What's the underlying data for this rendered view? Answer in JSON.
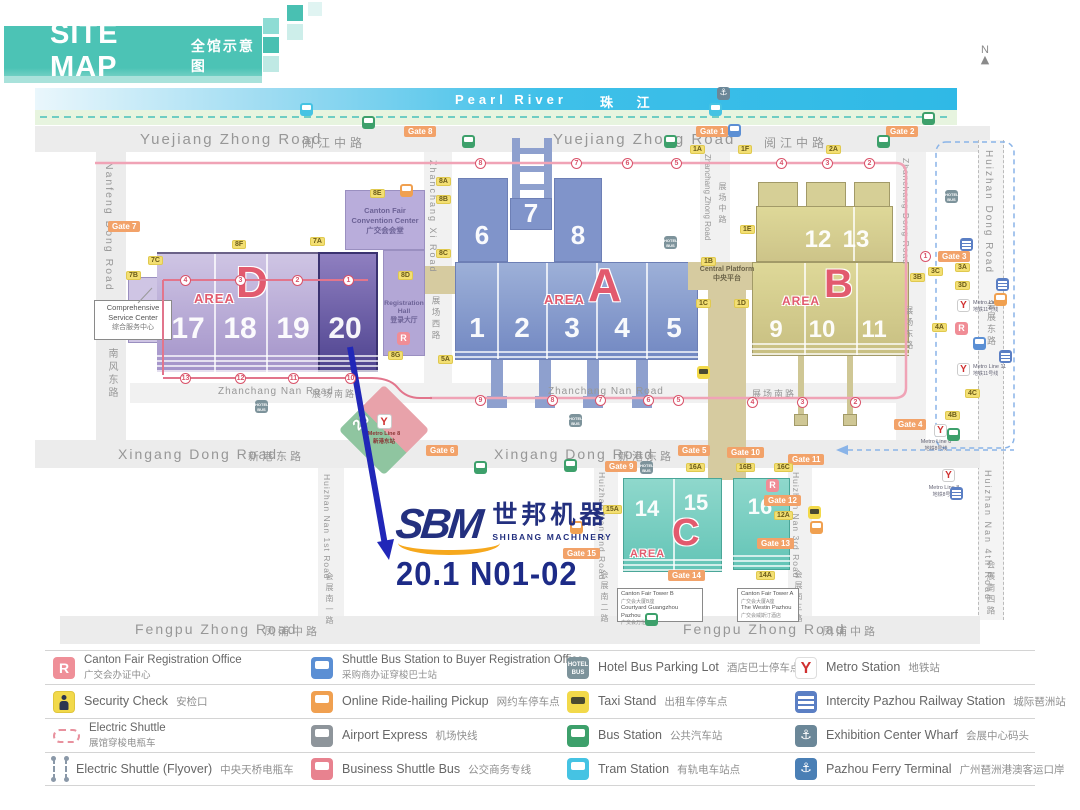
{
  "colors": {
    "accent_teal": "#4cc3b5",
    "booth_navy": "#1d2b87",
    "arrow_blue": "#2127b8",
    "area_letter": "#e25a6e",
    "river_blue": "#2fb9e6"
  },
  "header": {
    "title": "SITE MAP",
    "subtitle": "全馆示意图"
  },
  "compass": {
    "label": "N"
  },
  "river": {
    "en": "Pearl River",
    "zh": "珠 江"
  },
  "roads": {
    "yuejiang_en": "Yuejiang Zhong Road",
    "yuejiang_zh": "阅江中路",
    "nanfeng_en": "Nanfeng Dong Road",
    "nanfeng_zh": "南风东路",
    "huizhan_dong_en": "Huizhan Dong Road",
    "huizhan_dong_zh": "会展东路",
    "zhanchang_xi_en": "Zhanchang Xi Road",
    "zhanchang_xi_zh": "展场西路",
    "zhanchang_zhong_en": "Zhanchang Zhong Road",
    "zhanchang_zhong_zh": "展场中路",
    "zhanchang_dong_en": "Zhanchang Dong Road",
    "zhanchang_dong_zh": "展场东路",
    "zhanchang_nan_en": "Zhanchang Nan Road",
    "zhanchang_nan_zh": "展场南路",
    "xingang_en": "Xingang Dong Road",
    "xingang_zh": "新港东路",
    "fengpu_en": "Fengpu Zhong Road",
    "fengpu_zh": "凤浦中路",
    "hz1_en": "Huizhan Nan 1st Road",
    "hz1_zh": "会展南一路",
    "hz2_en": "Huizhan Nan 2nd Road",
    "hz2_zh": "会展南二路",
    "hz3_en": "Huizhan Nan 3rd Road",
    "hz3_zh": "会展南三路",
    "hz4_en": "Huizhan Nan 4th Road",
    "hz4_zh": "会展南四路"
  },
  "areas": {
    "a": {
      "word": "AREA",
      "letter": "A",
      "halls_top": [
        "6",
        "7",
        "8"
      ],
      "halls_bottom": [
        "1",
        "2",
        "3",
        "4",
        "5"
      ]
    },
    "b": {
      "word": "AREA",
      "letter": "B",
      "halls_top": [
        "12",
        "13"
      ],
      "halls_bottom": [
        "9",
        "10",
        "11"
      ]
    },
    "c": {
      "word": "AREA",
      "letter": "C",
      "halls": [
        "14",
        "15",
        "16"
      ]
    },
    "d": {
      "word": "AREA",
      "letter": "D",
      "halls": [
        "17",
        "18",
        "19",
        "20"
      ]
    }
  },
  "buildings": {
    "convention": {
      "en1": "Canton Fair",
      "en2": "Convention Center",
      "zh": "广交会会堂"
    },
    "registration": {
      "en": "Registration Hall",
      "zh": "登录大厅"
    },
    "service": {
      "en1": "Comprehensive",
      "en2": "Service Center",
      "zh": "综合服务中心"
    },
    "platform": {
      "en": "Central Platform",
      "zh": "中央平台"
    },
    "hotel_b": {
      "l1": "Canton Fair Tower B",
      "l2": "广交会大厦B座",
      "l3": "Courtyard Guangzhou Pazhou",
      "l4": "广交会万怡酒店"
    },
    "hotel_a": {
      "l1": "Canton Fair Tower A",
      "l2": "广交会大厦A座",
      "l3": "The Westin Pazhou",
      "l4": "广交会威斯汀酒店"
    }
  },
  "booth": {
    "logo": "SBM",
    "company_zh": "世邦机器",
    "company_en": "SHIBANG MACHINERY",
    "code": "20.1 N01-02"
  },
  "metro": {
    "diamond_num": "20",
    "diamond_line": "Metro Line 8",
    "diamond_station": "新港东站",
    "line11": "Metro Line 11",
    "line11_zh": "地铁11号线",
    "line8": "Metro Line 8",
    "line8_zh": "地铁8号线"
  },
  "map": {
    "gates": [
      {
        "label": "Gate 7",
        "x": 108,
        "y": 221
      },
      {
        "label": "Gate 8",
        "x": 404,
        "y": 126
      },
      {
        "label": "Gate 1",
        "x": 696,
        "y": 126
      },
      {
        "label": "Gate 2",
        "x": 886,
        "y": 126
      },
      {
        "label": "Gate 3",
        "x": 938,
        "y": 251
      },
      {
        "label": "Gate 4",
        "x": 894,
        "y": 419
      },
      {
        "label": "Gate 5",
        "x": 678,
        "y": 445
      },
      {
        "label": "Gate 6",
        "x": 426,
        "y": 445
      },
      {
        "label": "Gate 9",
        "x": 605,
        "y": 461
      },
      {
        "label": "Gate 10",
        "x": 727,
        "y": 447
      },
      {
        "label": "Gate 11",
        "x": 788,
        "y": 454
      },
      {
        "label": "Gate 12",
        "x": 764,
        "y": 495
      },
      {
        "label": "Gate 13",
        "x": 757,
        "y": 538
      },
      {
        "label": "Gate 14",
        "x": 668,
        "y": 570
      },
      {
        "label": "Gate 15",
        "x": 563,
        "y": 548
      }
    ],
    "chips": [
      {
        "label": "7B",
        "x": 126,
        "y": 271
      },
      {
        "label": "7C",
        "x": 148,
        "y": 256
      },
      {
        "label": "8F",
        "x": 232,
        "y": 240
      },
      {
        "label": "7A",
        "x": 310,
        "y": 237
      },
      {
        "label": "8E",
        "x": 370,
        "y": 189
      },
      {
        "label": "8A",
        "x": 436,
        "y": 177
      },
      {
        "label": "8B",
        "x": 436,
        "y": 195
      },
      {
        "label": "8C",
        "x": 436,
        "y": 249
      },
      {
        "label": "8D",
        "x": 398,
        "y": 271
      },
      {
        "label": "8G",
        "x": 388,
        "y": 351
      },
      {
        "label": "5A",
        "x": 438,
        "y": 355
      },
      {
        "label": "1A",
        "x": 690,
        "y": 145
      },
      {
        "label": "1F",
        "x": 738,
        "y": 145
      },
      {
        "label": "2A",
        "x": 826,
        "y": 145
      },
      {
        "label": "1E",
        "x": 740,
        "y": 225
      },
      {
        "label": "1B",
        "x": 701,
        "y": 257
      },
      {
        "label": "1C",
        "x": 696,
        "y": 299
      },
      {
        "label": "1D",
        "x": 734,
        "y": 299
      },
      {
        "label": "3C",
        "x": 928,
        "y": 267
      },
      {
        "label": "3B",
        "x": 910,
        "y": 273
      },
      {
        "label": "3A",
        "x": 955,
        "y": 263
      },
      {
        "label": "3D",
        "x": 955,
        "y": 281
      },
      {
        "label": "4A",
        "x": 932,
        "y": 323
      },
      {
        "label": "4C",
        "x": 965,
        "y": 389
      },
      {
        "label": "4B",
        "x": 945,
        "y": 411
      },
      {
        "label": "16A",
        "x": 686,
        "y": 463
      },
      {
        "label": "16B",
        "x": 736,
        "y": 463
      },
      {
        "label": "16C",
        "x": 774,
        "y": 463
      },
      {
        "label": "12A",
        "x": 774,
        "y": 511
      },
      {
        "label": "14A",
        "x": 756,
        "y": 571
      },
      {
        "label": "15A",
        "x": 603,
        "y": 505
      }
    ],
    "stops": [
      {
        "n": "4",
        "x": 180,
        "y": 275
      },
      {
        "n": "3",
        "x": 235,
        "y": 275
      },
      {
        "n": "2",
        "x": 292,
        "y": 275
      },
      {
        "n": "1",
        "x": 343,
        "y": 275
      },
      {
        "n": "8",
        "x": 475,
        "y": 158
      },
      {
        "n": "7",
        "x": 571,
        "y": 158
      },
      {
        "n": "6",
        "x": 622,
        "y": 158
      },
      {
        "n": "5",
        "x": 671,
        "y": 158
      },
      {
        "n": "4",
        "x": 776,
        "y": 158
      },
      {
        "n": "3",
        "x": 822,
        "y": 158
      },
      {
        "n": "2",
        "x": 864,
        "y": 158
      },
      {
        "n": "1",
        "x": 920,
        "y": 251
      },
      {
        "n": "13",
        "x": 180,
        "y": 373
      },
      {
        "n": "12",
        "x": 235,
        "y": 373
      },
      {
        "n": "11",
        "x": 288,
        "y": 373
      },
      {
        "n": "10",
        "x": 345,
        "y": 373
      },
      {
        "n": "9",
        "x": 475,
        "y": 395
      },
      {
        "n": "8",
        "x": 547,
        "y": 395
      },
      {
        "n": "7",
        "x": 595,
        "y": 395
      },
      {
        "n": "6",
        "x": 643,
        "y": 395
      },
      {
        "n": "5",
        "x": 673,
        "y": 395
      },
      {
        "n": "4",
        "x": 747,
        "y": 397
      },
      {
        "n": "3",
        "x": 797,
        "y": 397
      },
      {
        "n": "2",
        "x": 850,
        "y": 397
      }
    ],
    "icons": [
      {
        "cls": "mi-veh mi-tram",
        "x": 300,
        "y": 103,
        "name": "tram-station-icon"
      },
      {
        "cls": "mi-veh mi-tram",
        "x": 709,
        "y": 103,
        "name": "tram-station-icon"
      },
      {
        "cls": "mi-anchor",
        "x": 717,
        "y": 87,
        "name": "wharf-icon"
      },
      {
        "cls": "mi-veh mi-bus",
        "x": 362,
        "y": 116,
        "name": "bus-station-icon"
      },
      {
        "cls": "mi-veh mi-bus",
        "x": 462,
        "y": 135,
        "name": "bus-station-icon"
      },
      {
        "cls": "mi-veh mi-bus",
        "x": 664,
        "y": 135,
        "name": "bus-station-icon"
      },
      {
        "cls": "mi-veh mi-bus",
        "x": 877,
        "y": 135,
        "name": "bus-station-icon"
      },
      {
        "cls": "mi-veh mi-bus",
        "x": 922,
        "y": 112,
        "name": "bus-station-icon"
      },
      {
        "cls": "mi-veh mi-bus",
        "x": 564,
        "y": 459,
        "name": "bus-station-icon"
      },
      {
        "cls": "mi-veh mi-bus",
        "x": 474,
        "y": 461,
        "name": "bus-station-icon"
      },
      {
        "cls": "mi-veh mi-bus",
        "x": 645,
        "y": 613,
        "name": "bus-station-icon"
      },
      {
        "cls": "mi-veh mi-bus",
        "x": 947,
        "y": 428,
        "name": "bus-station-icon"
      },
      {
        "cls": "mi-hotel",
        "x": 255,
        "y": 400,
        "name": "hotel-bus-icon"
      },
      {
        "cls": "mi-hotel",
        "x": 569,
        "y": 414,
        "name": "hotel-bus-icon"
      },
      {
        "cls": "mi-hotel",
        "x": 640,
        "y": 461,
        "name": "hotel-bus-icon"
      },
      {
        "cls": "mi-hotel",
        "x": 664,
        "y": 236,
        "name": "hotel-bus-icon"
      },
      {
        "cls": "mi-hotel",
        "x": 945,
        "y": 190,
        "name": "hotel-bus-icon"
      },
      {
        "cls": "mi-taxi",
        "x": 697,
        "y": 366,
        "name": "taxi-stand-icon"
      },
      {
        "cls": "mi-taxi",
        "x": 808,
        "y": 506,
        "name": "taxi-stand-icon"
      },
      {
        "cls": "mi-veh mi-ride",
        "x": 400,
        "y": 184,
        "name": "ride-hailing-icon"
      },
      {
        "cls": "mi-veh mi-ride",
        "x": 570,
        "y": 521,
        "name": "ride-hailing-icon"
      },
      {
        "cls": "mi-veh mi-ride",
        "x": 810,
        "y": 521,
        "name": "ride-hailing-icon"
      },
      {
        "cls": "mi-veh mi-ride",
        "x": 994,
        "y": 293,
        "name": "ride-hailing-icon"
      },
      {
        "cls": "mi-veh mi-blue",
        "x": 728,
        "y": 124,
        "name": "shuttle-bus-icon"
      },
      {
        "cls": "mi-veh mi-blue",
        "x": 973,
        "y": 337,
        "name": "shuttle-bus-icon"
      },
      {
        "cls": "mi-rail",
        "x": 960,
        "y": 238,
        "name": "intercity-rail-icon"
      },
      {
        "cls": "mi-rail",
        "x": 996,
        "y": 278,
        "name": "intercity-rail-icon"
      },
      {
        "cls": "mi-rail",
        "x": 999,
        "y": 350,
        "name": "intercity-rail-icon"
      },
      {
        "cls": "mi-rail",
        "x": 950,
        "y": 487,
        "name": "intercity-rail-icon"
      },
      {
        "cls": "mi-metro",
        "x": 957,
        "y": 299,
        "name": "metro-station-icon"
      },
      {
        "cls": "mi-metro",
        "x": 957,
        "y": 363,
        "name": "metro-station-icon"
      },
      {
        "cls": "mi-metro",
        "x": 934,
        "y": 424,
        "name": "metro-station-icon"
      },
      {
        "cls": "mi-metro",
        "x": 942,
        "y": 469,
        "name": "metro-station-icon"
      },
      {
        "cls": "mi-r",
        "x": 397,
        "y": 332,
        "name": "registration-office-icon"
      },
      {
        "cls": "mi-r",
        "x": 766,
        "y": 479,
        "name": "registration-office-icon"
      },
      {
        "cls": "mi-r",
        "x": 955,
        "y": 322,
        "name": "registration-office-icon"
      }
    ]
  },
  "legend": {
    "items": [
      {
        "icon": "lg-reg",
        "icon_name": "registration-office-icon",
        "en": "Canton Fair Registration Office",
        "zh": "广交会办证中心",
        "cls": "stack"
      },
      {
        "icon": "lg-sec",
        "icon_name": "security-check-icon",
        "en": "Security Check",
        "zh": "安检口"
      },
      {
        "icon": "lg-es",
        "icon_name": "electric-shuttle-icon",
        "en": "Electric Shuttle",
        "zh": "展馆穿梭电瓶车",
        "cls": "stack"
      },
      {
        "icon": "lg-fly",
        "icon_name": "electric-shuttle-flyover-icon",
        "en": "Electric Shuttle (Flyover)",
        "zh": "中央天桥电瓶车",
        "cls": "last"
      },
      {
        "icon": "lg-veh lg-sbus",
        "icon_name": "shuttle-bus-icon",
        "en": "Shuttle Bus Station to Buyer Registration Office",
        "zh": "采购商办证穿梭巴士站",
        "cls": "stack"
      },
      {
        "icon": "lg-veh lg-ride",
        "icon_name": "ride-hailing-icon",
        "en": "Online Ride-hailing Pickup",
        "zh": "网约车停车点"
      },
      {
        "icon": "lg-veh lg-air",
        "icon_name": "airport-express-icon",
        "en": "Airport Express",
        "zh": "机场快线"
      },
      {
        "icon": "lg-veh lg-bbus",
        "icon_name": "business-shuttle-icon",
        "en": "Business Shuttle Bus",
        "zh": "公交商务专线",
        "cls": "last"
      },
      {
        "icon": "lg-hotel",
        "icon_name": "hotel-bus-icon",
        "en": "Hotel Bus Parking Lot",
        "zh": "酒店巴士停车点"
      },
      {
        "icon": "lg-taxi",
        "icon_name": "taxi-stand-icon",
        "en": "Taxi Stand",
        "zh": "出租车停车点"
      },
      {
        "icon": "lg-veh lg-bus",
        "icon_name": "bus-station-icon",
        "en": "Bus Station",
        "zh": "公共汽车站"
      },
      {
        "icon": "lg-veh lg-tram",
        "icon_name": "tram-station-icon",
        "en": "Tram Station",
        "zh": "有轨电车站点",
        "cls": "last"
      },
      {
        "icon": "lg-metro",
        "icon_name": "metro-station-icon",
        "en": "Metro Station",
        "zh": "地铁站"
      },
      {
        "icon": "lg-rail",
        "icon_name": "intercity-rail-icon",
        "en": "Intercity Pazhou Railway Station",
        "zh": "城际琶洲站"
      },
      {
        "icon": "lg-wharf",
        "icon_name": "wharf-icon",
        "en": "Exhibition Center Wharf",
        "zh": "会展中心码头"
      },
      {
        "icon": "lg-ferry",
        "icon_name": "ferry-terminal-icon",
        "en": "Pazhou Ferry Terminal",
        "zh": "广州琶洲港澳客运口岸",
        "cls": "last"
      }
    ]
  }
}
